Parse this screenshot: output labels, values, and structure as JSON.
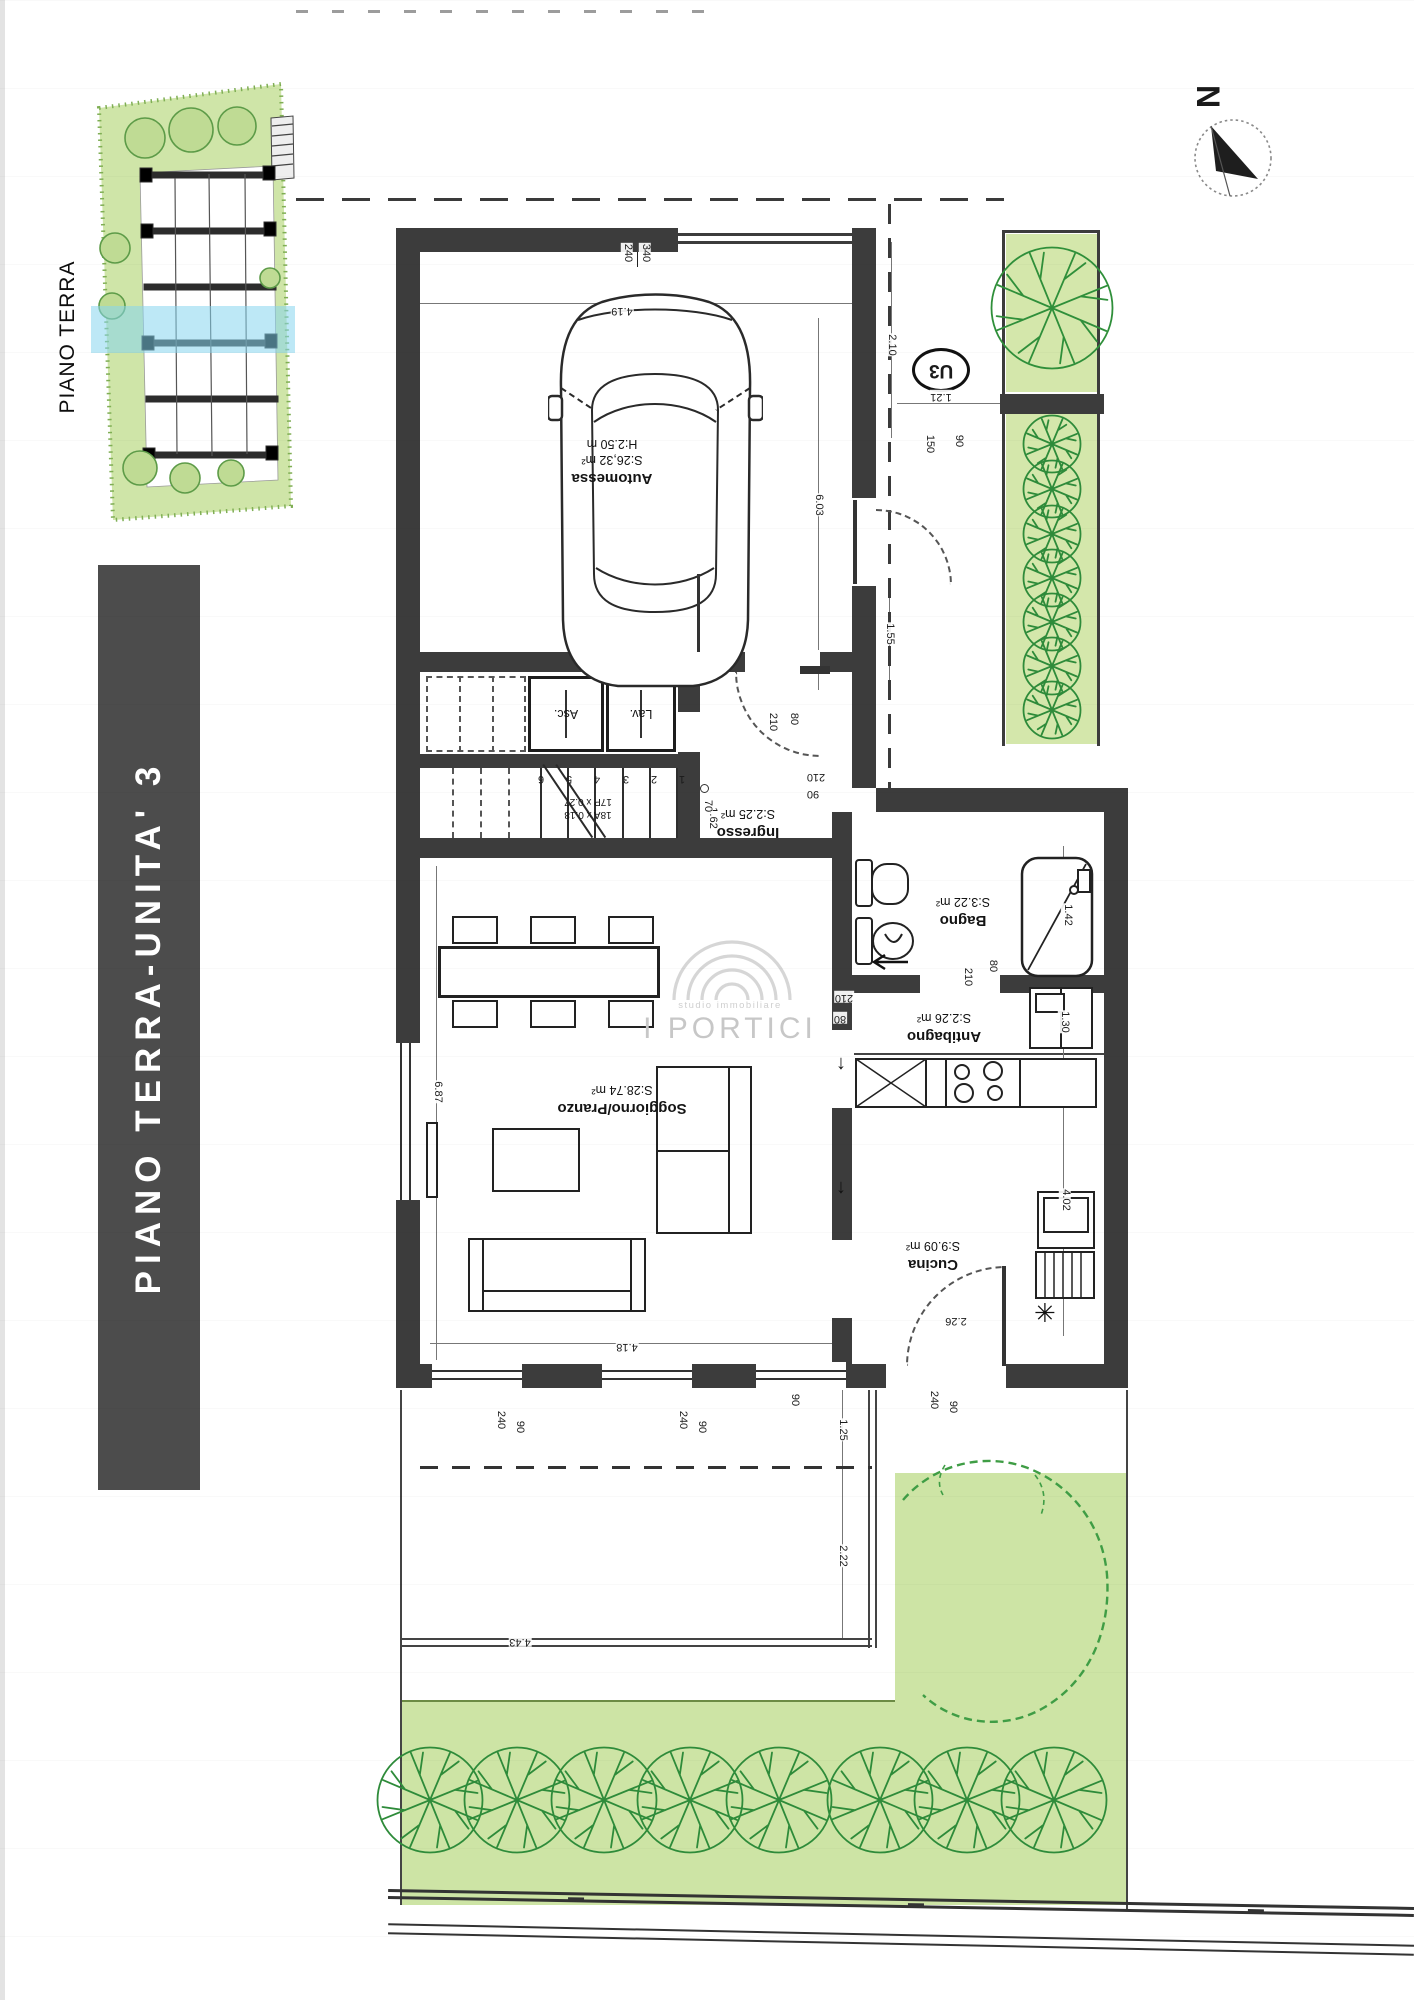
{
  "banner": {
    "label": "PIANO TERRA-UNITA' 3",
    "bg": "#4c4c4c",
    "fg": "#ffffff"
  },
  "inset": {
    "label": "PIANO TERRA",
    "highlight_color": "#86d5ef"
  },
  "compass": {
    "label": "N"
  },
  "unit_badge": {
    "label": "U3"
  },
  "watermark": {
    "line1": "studio immobiliare",
    "line2": "I PORTICI"
  },
  "rooms": [
    {
      "name": "Automessa",
      "area": "S:26,32 m²",
      "extra": "H:2.50 m"
    },
    {
      "name": "Ingresso",
      "area": "S:2.25 m²"
    },
    {
      "name": "Bagno",
      "area": "S:3.22 m²"
    },
    {
      "name": "Antibagno",
      "area": "S:2.26 m²"
    },
    {
      "name": "Cucina",
      "area": "S:9.09 m²"
    },
    {
      "name": "Soggiorno/Pranzo",
      "area": "S:28.74 m²"
    }
  ],
  "stairs": {
    "steps": [
      "1",
      "2",
      "3",
      "4",
      "5",
      "6"
    ],
    "riser_label": "18A x 0.18",
    "tread_label": "17P x 0.27",
    "asc": "Asc.",
    "lav": "Lav."
  },
  "dims": [
    {
      "v": "340",
      "x": 645,
      "y": 253,
      "r": 90
    },
    {
      "v": "240",
      "x": 627,
      "y": 253,
      "r": 90
    },
    {
      "v": "4.19",
      "x": 622,
      "y": 310,
      "r": 180
    },
    {
      "v": "6.03",
      "x": 818,
      "y": 505,
      "r": 90
    },
    {
      "v": "2.10",
      "x": 891,
      "y": 345,
      "r": 90
    },
    {
      "v": "1.21",
      "x": 941,
      "y": 396,
      "r": 180
    },
    {
      "v": "150",
      "x": 929,
      "y": 444,
      "r": 90
    },
    {
      "v": "90",
      "x": 958,
      "y": 441,
      "r": 90
    },
    {
      "v": "1.55",
      "x": 889,
      "y": 634,
      "r": 90
    },
    {
      "v": "210",
      "x": 772,
      "y": 722,
      "r": 90
    },
    {
      "v": "80",
      "x": 793,
      "y": 719,
      "r": 90
    },
    {
      "v": "210",
      "x": 816,
      "y": 776,
      "r": 180
    },
    {
      "v": "90",
      "x": 813,
      "y": 793,
      "r": 180
    },
    {
      "v": "1.62",
      "x": 712,
      "y": 818,
      "r": 90
    },
    {
      "v": "70",
      "x": 707,
      "y": 806,
      "r": 90
    },
    {
      "v": "210",
      "x": 967,
      "y": 977,
      "r": 90
    },
    {
      "v": "80",
      "x": 992,
      "y": 966,
      "r": 90
    },
    {
      "v": "210",
      "x": 844,
      "y": 997,
      "r": 180
    },
    {
      "v": "80",
      "x": 840,
      "y": 1018,
      "r": 180
    },
    {
      "v": "1.42",
      "x": 1067,
      "y": 915,
      "r": 90
    },
    {
      "v": "1.30",
      "x": 1064,
      "y": 1022,
      "r": 90
    },
    {
      "v": "4.02",
      "x": 1065,
      "y": 1200,
      "r": 90
    },
    {
      "v": "2.26",
      "x": 956,
      "y": 1320,
      "r": 180
    },
    {
      "v": "6.87",
      "x": 437,
      "y": 1092,
      "r": 90
    },
    {
      "v": "4.18",
      "x": 627,
      "y": 1346,
      "r": 180
    },
    {
      "v": "240",
      "x": 500,
      "y": 1420,
      "r": 90
    },
    {
      "v": "90",
      "x": 519,
      "y": 1427,
      "r": 90
    },
    {
      "v": "240",
      "x": 682,
      "y": 1420,
      "r": 90
    },
    {
      "v": "90",
      "x": 701,
      "y": 1427,
      "r": 90
    },
    {
      "v": "240",
      "x": 933,
      "y": 1400,
      "r": 90
    },
    {
      "v": "90",
      "x": 952,
      "y": 1407,
      "r": 90
    },
    {
      "v": "90",
      "x": 794,
      "y": 1400,
      "r": 90
    },
    {
      "v": "1.25",
      "x": 842,
      "y": 1430,
      "r": 90
    },
    {
      "v": "2.22",
      "x": 842,
      "y": 1556,
      "r": 90
    },
    {
      "v": "4.43",
      "x": 520,
      "y": 1641,
      "r": 180
    }
  ],
  "garden": {
    "row_shrub_y": 1800,
    "row_shrub_xs": [
      430,
      517,
      604,
      690,
      779,
      880,
      967,
      1054
    ],
    "side_bed_x": 1052,
    "side_bed_shrub_ys": [
      444,
      489,
      534,
      578,
      622,
      666,
      710
    ],
    "grass_color": "#cde4a5",
    "shrub_color": "#2e8b3a"
  },
  "colors": {
    "wall": "#3c3c3c",
    "highlight_band": "#86d5ef",
    "watermark": "#c7c7c7"
  }
}
